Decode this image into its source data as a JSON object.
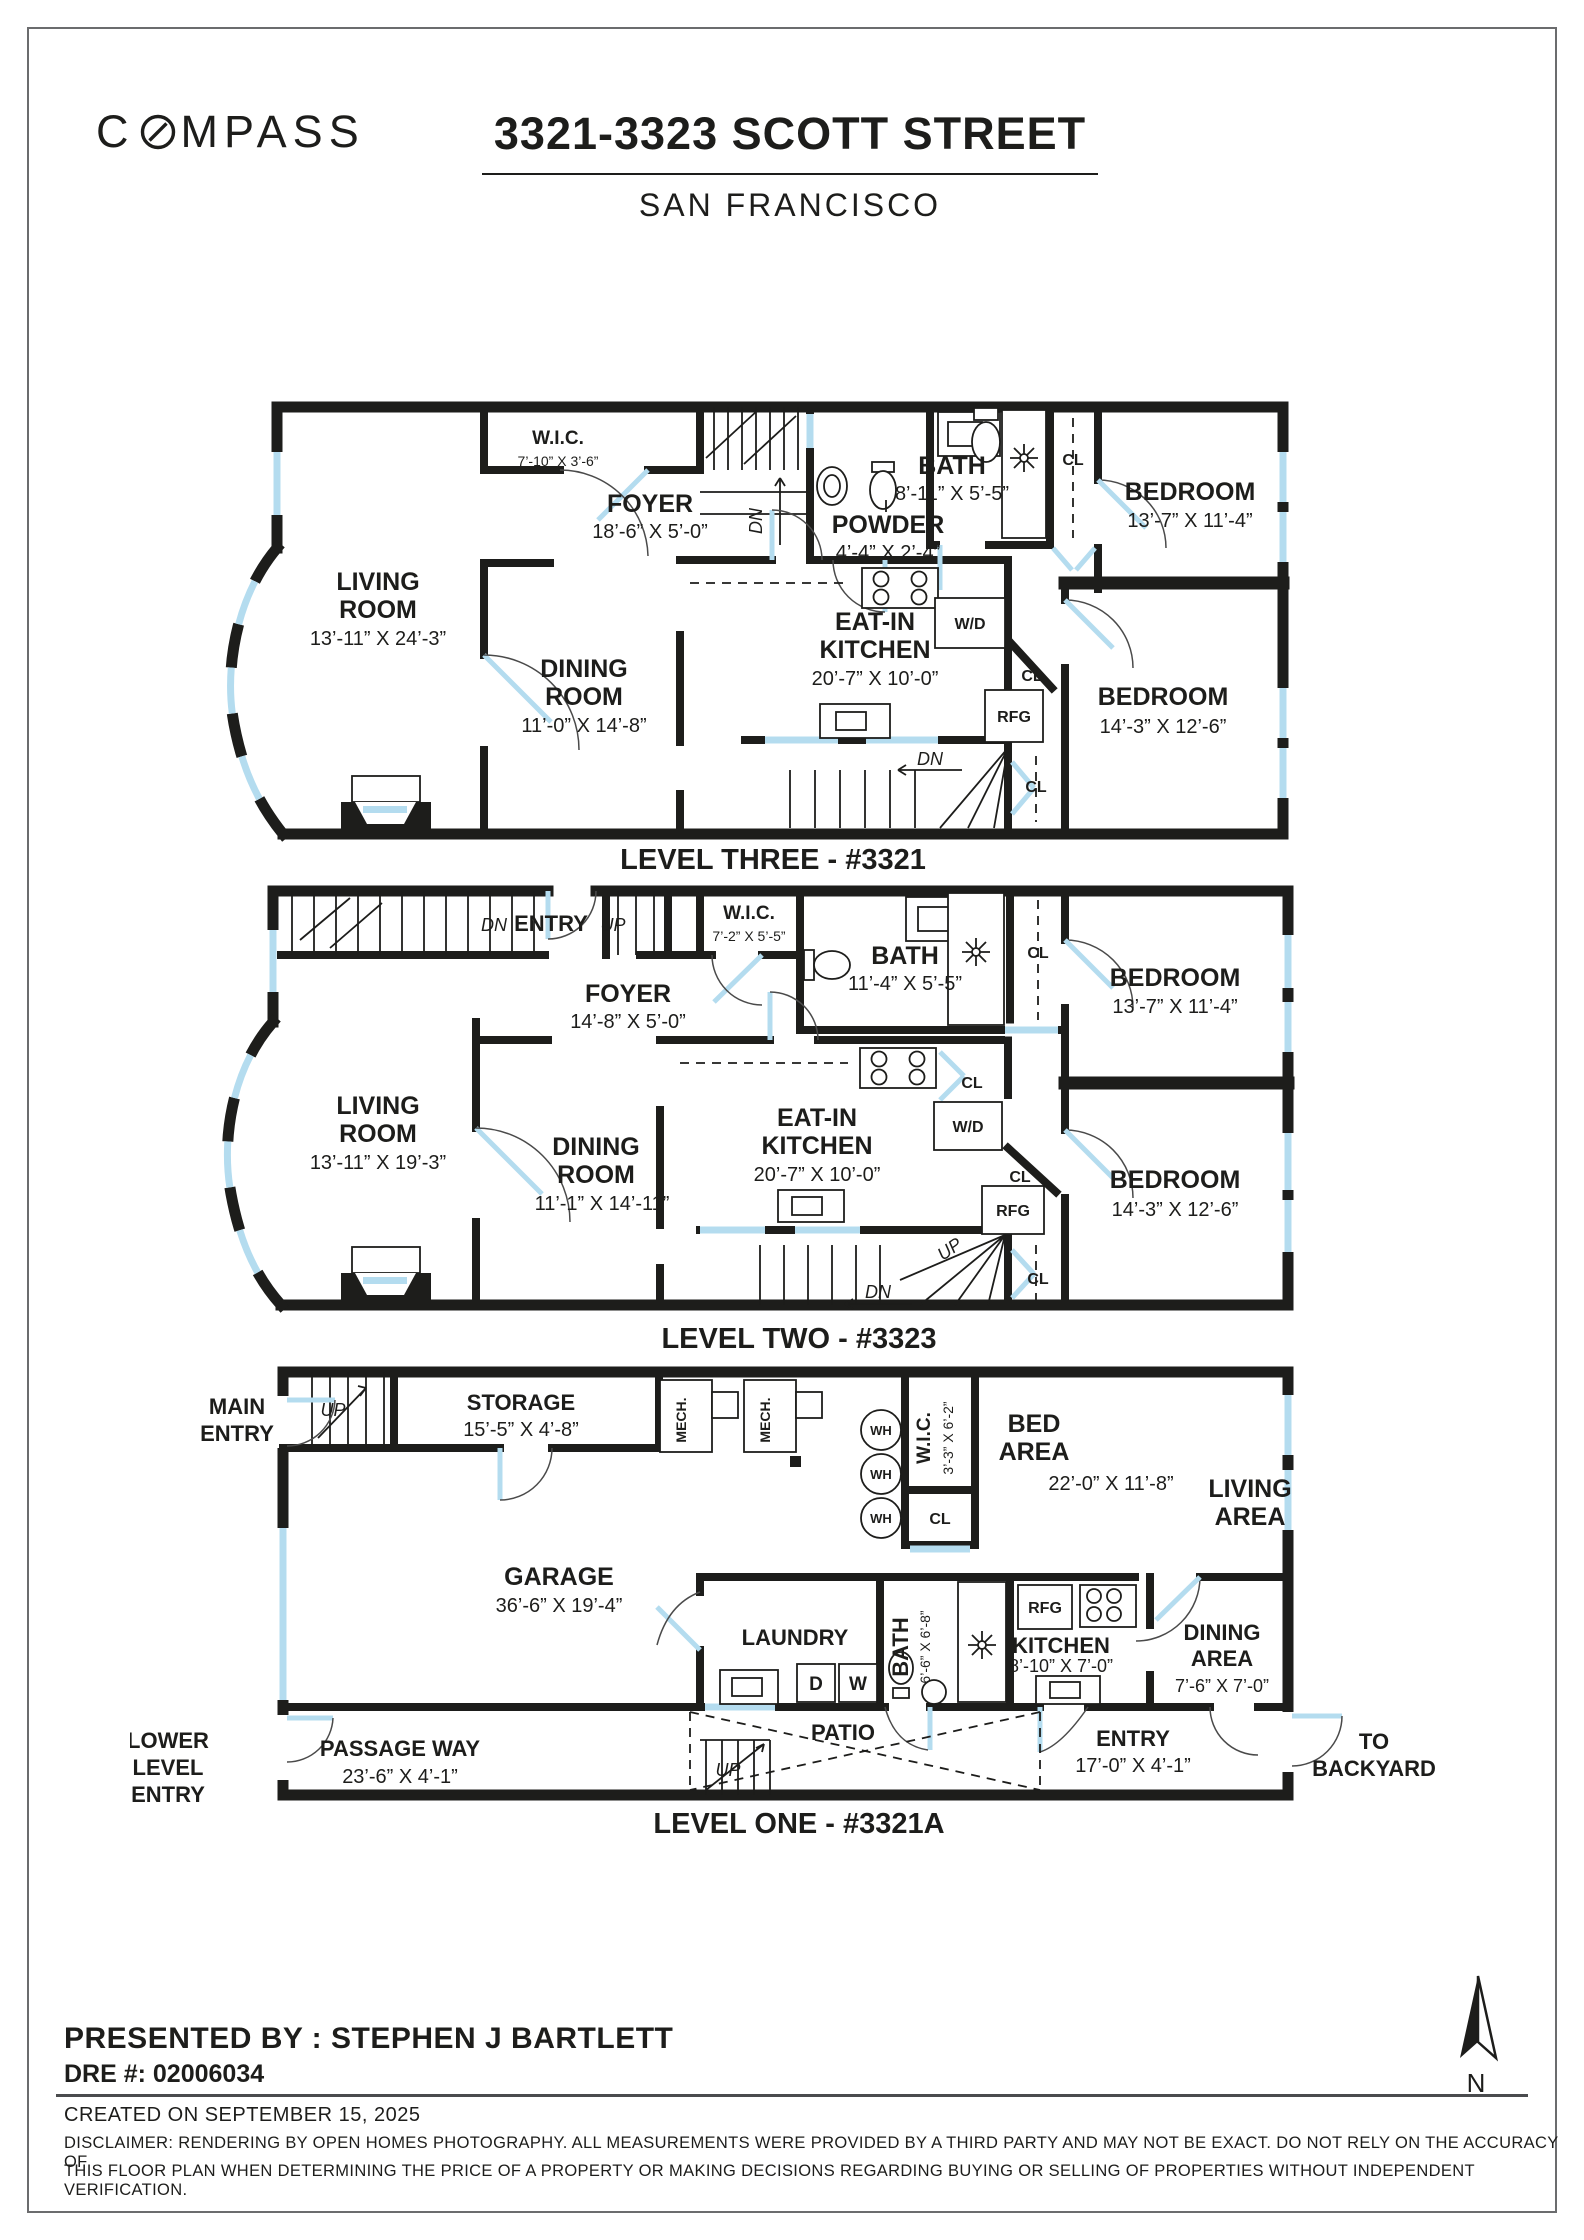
{
  "header": {
    "brand_c": "C",
    "brand_rest": "MPASS",
    "title": "3321-3323 SCOTT STREET",
    "subtitle": "SAN FRANCISCO"
  },
  "glossary": {
    "cl": "CL",
    "wd": "W/D",
    "rfg": "RFG",
    "wh": "WH",
    "dn": "DN",
    "up": "UP",
    "mech": "MECH.",
    "d": "D",
    "w": "W"
  },
  "levels": [
    {
      "label": "LEVEL THREE - #3321",
      "rooms": {
        "living": {
          "l1": "LIVING",
          "l2": "ROOM",
          "dims": "13’-11” X 24’-3”"
        },
        "wic": {
          "name": "W.I.C.",
          "dims": "7’-10” X 3’-6”"
        },
        "foyer": {
          "name": "FOYER",
          "dims": "18’-6” X 5’-0”"
        },
        "powder": {
          "name": "POWDER",
          "dims": "4’-4” X 2’-4”"
        },
        "bath": {
          "name": "BATH",
          "dims": "8’-11” X 5’-5”"
        },
        "bedroom1": {
          "name": "BEDROOM",
          "dims": "13’-7” X 11’-4”"
        },
        "dining": {
          "l1": "DINING",
          "l2": "ROOM",
          "dims": "11’-0” X 14’-8”"
        },
        "kitchen": {
          "l1": "EAT-IN",
          "l2": "KITCHEN",
          "dims": "20’-7” X 10’-0”"
        },
        "bedroom2": {
          "name": "BEDROOM",
          "dims": "14’-3” X 12’-6”"
        }
      }
    },
    {
      "label": "LEVEL TWO - #3323",
      "rooms": {
        "entry": {
          "name": "ENTRY"
        },
        "wic": {
          "name": "W.I.C.",
          "dims": "7’-2” X 5’-5”"
        },
        "foyer": {
          "name": "FOYER",
          "dims": "14’-8” X 5’-0”"
        },
        "bath": {
          "name": "BATH",
          "dims": "11’-4” X 5’-5”"
        },
        "bedroom1": {
          "name": "BEDROOM",
          "dims": "13’-7” X 11’-4”"
        },
        "living": {
          "l1": "LIVING",
          "l2": "ROOM",
          "dims": "13’-11” X 19’-3”"
        },
        "dining": {
          "l1": "DINING",
          "l2": "ROOM",
          "dims": "11’-1” X 14’-11”"
        },
        "kitchen": {
          "l1": "EAT-IN",
          "l2": "KITCHEN",
          "dims": "20’-7” X 10’-0”"
        },
        "bedroom2": {
          "name": "BEDROOM",
          "dims": "14’-3” X 12’-6”"
        }
      }
    },
    {
      "label": "LEVEL ONE - #3321A",
      "rooms": {
        "main_entry": {
          "l1": "MAIN",
          "l2": "ENTRY"
        },
        "storage": {
          "name": "STORAGE",
          "dims": "15’-5” X 4’-8”"
        },
        "wic": {
          "name": "W.I.C.",
          "dims": "3’-3” X 6’-2”"
        },
        "bed_area": {
          "l1": "BED",
          "l2": "AREA",
          "dims": "22’-0” X 11’-8”"
        },
        "living_area": {
          "l1": "LIVING",
          "l2": "AREA"
        },
        "garage": {
          "name": "GARAGE",
          "dims": "36’-6” X 19’-4”"
        },
        "laundry": {
          "name": "LAUNDRY"
        },
        "bath": {
          "name": "BATH",
          "dims": "6’-6” X 6’-8”"
        },
        "kitchen": {
          "name": "KITCHEN",
          "dims": "8’-10” X 7’-0”"
        },
        "dining_area": {
          "l1": "DINING",
          "l2": "AREA",
          "dims": "7’-6” X 7’-0”"
        },
        "passage": {
          "name": "PASSAGE WAY",
          "dims": "23’-6” X 4’-1”"
        },
        "patio": {
          "name": "PATIO"
        },
        "entry": {
          "name": "ENTRY",
          "dims": "17’-0” X 4’-1”"
        },
        "lower_entry": {
          "l1": "LOWER",
          "l2": "LEVEL",
          "l3": "ENTRY"
        },
        "backyard": {
          "l1": "TO",
          "l2": "BACKYARD"
        }
      }
    }
  ],
  "footer": {
    "presented_by": "PRESENTED BY : STEPHEN J BARTLETT",
    "dre": "DRE #: 02006034",
    "created": "CREATED ON SEPTEMBER 15, 2025",
    "disclaimer1": "DISCLAIMER: RENDERING BY OPEN HOMES PHOTOGRAPHY. ALL MEASUREMENTS WERE PROVIDED BY A THIRD PARTY AND MAY NOT BE EXACT. DO NOT RELY ON THE ACCURACY OF",
    "disclaimer2": "THIS FLOOR PLAN WHEN DETERMINING THE PRICE OF A PROPERTY OR MAKING DECISIONS REGARDING BUYING OR SELLING OF PROPERTIES WITHOUT INDEPENDENT VERIFICATION.",
    "north": "N"
  }
}
